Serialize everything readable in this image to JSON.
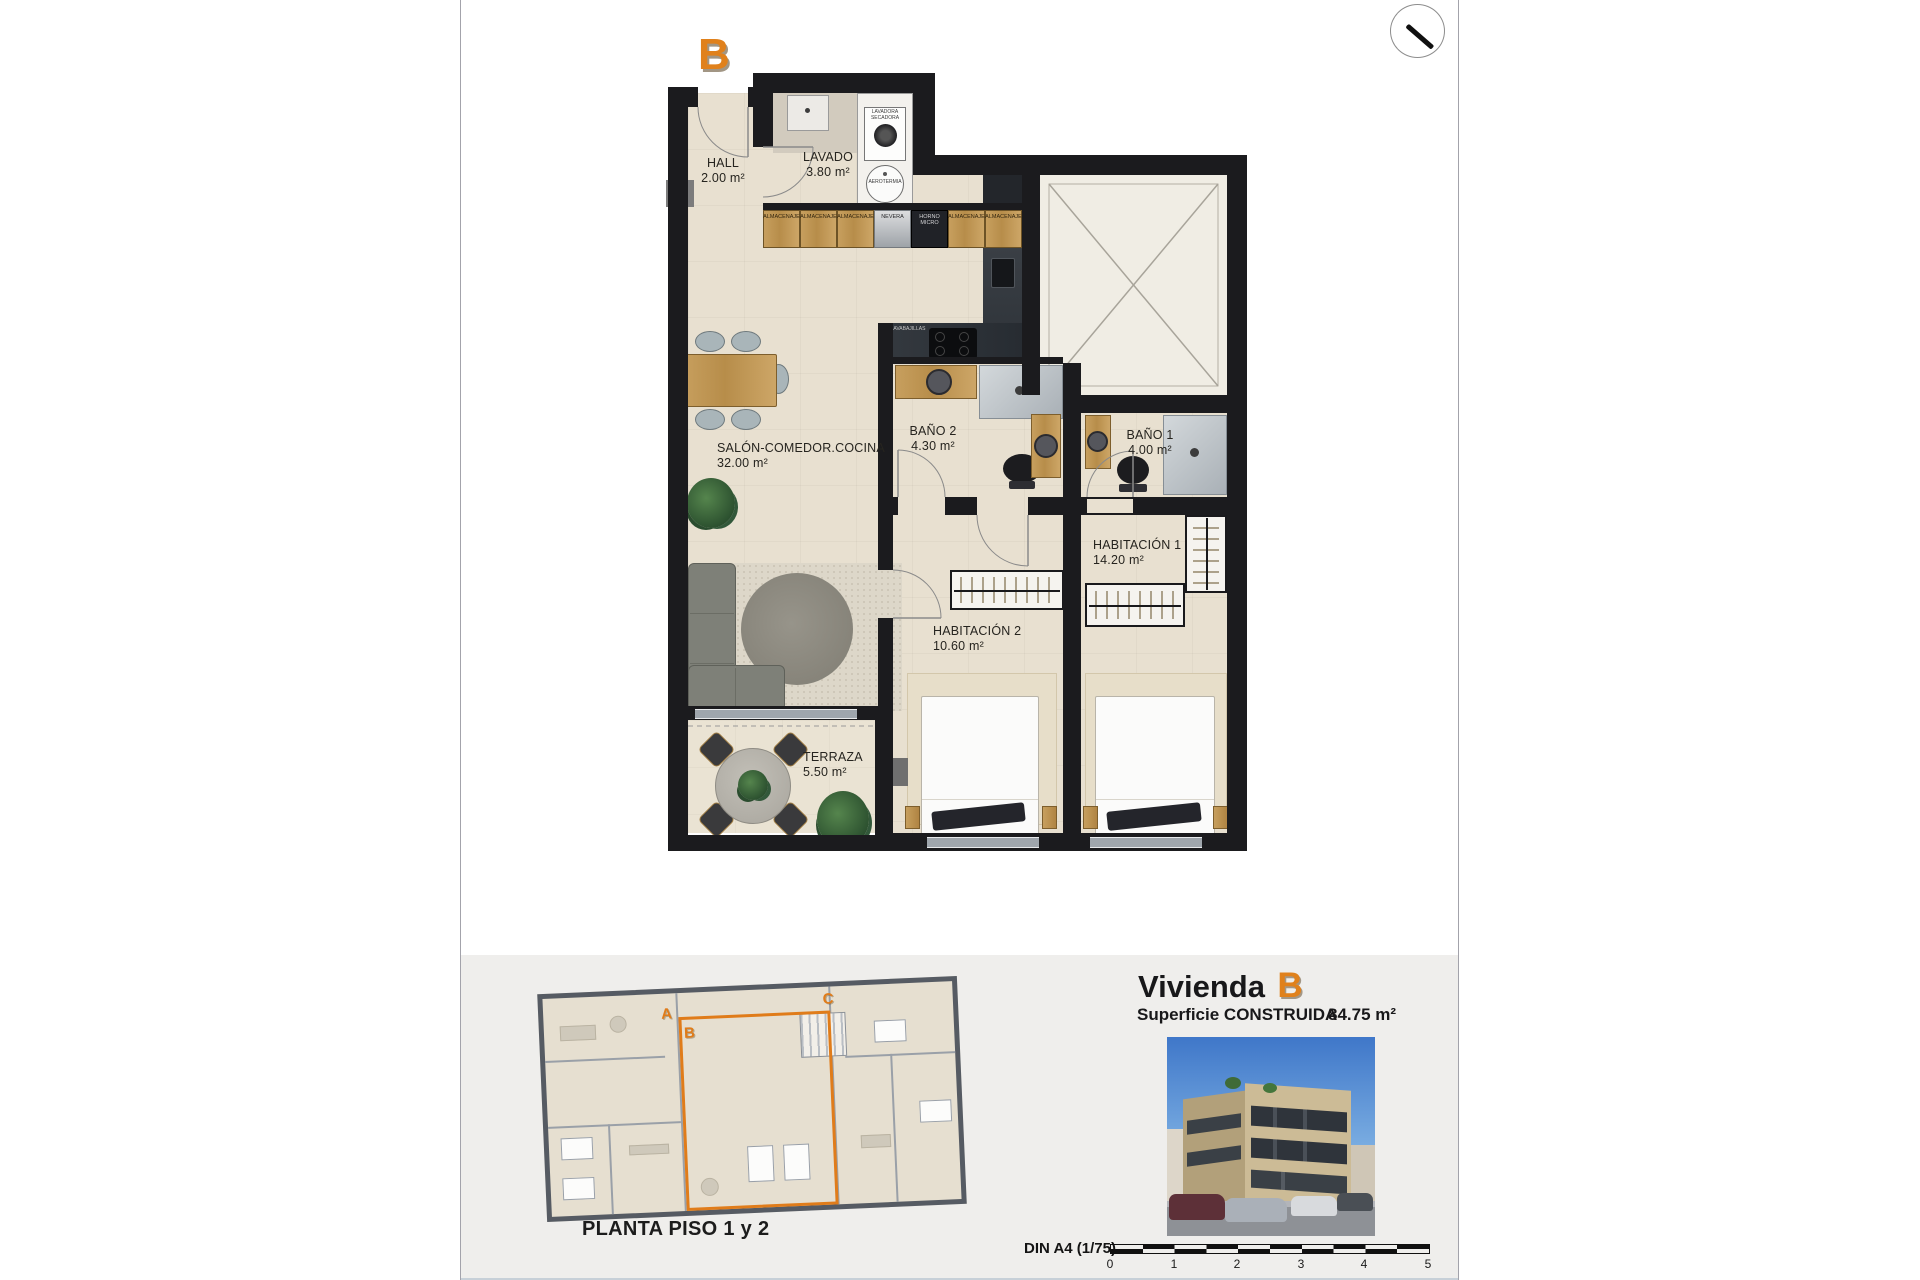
{
  "page": {
    "unit_marker": "B",
    "accent_color": "#e07c1a"
  },
  "plan": {
    "rooms": [
      {
        "name": "HALL",
        "area": "2.00 m²"
      },
      {
        "name": "LAVADO",
        "area": "3.80 m²"
      },
      {
        "name": "SALÓN-COMEDOR.COCINA",
        "area": "32.00 m²"
      },
      {
        "name": "BAÑO 2",
        "area": "4.30 m²"
      },
      {
        "name": "BAÑO 1",
        "area": "4.00 m²"
      },
      {
        "name": "HABITACIÓN 1",
        "area": "14.20 m²"
      },
      {
        "name": "HABITACIÓN 2",
        "area": "10.60 m²"
      },
      {
        "name": "TERRAZA",
        "area": "5.50 m²"
      }
    ],
    "kitchen_units": [
      "ALMACENAJE",
      "ALMACENAJE",
      "ALMACENAJE",
      "NEVERA",
      "HORNO MICRO",
      "ALMACENAJE",
      "ALMACENAJE"
    ],
    "equipment": {
      "washer": "LAVADORA SECADORA",
      "heat_pump": "AEROTERMIA",
      "dishwasher": "LAVABAJILLAS"
    }
  },
  "footer": {
    "floor_plan_caption": "PLANTA PISO 1 y 2",
    "mini_plan_units": [
      "A",
      "B",
      "C"
    ],
    "title_prefix": "Vivienda",
    "title_letter": "B",
    "surface_label": "Superficie CONSTRUIDA",
    "surface_value": "84.75 m²",
    "scale_caption": "DIN A4 (1/75)",
    "scale_ticks": [
      "0",
      "1",
      "2",
      "3",
      "4",
      "5"
    ]
  }
}
